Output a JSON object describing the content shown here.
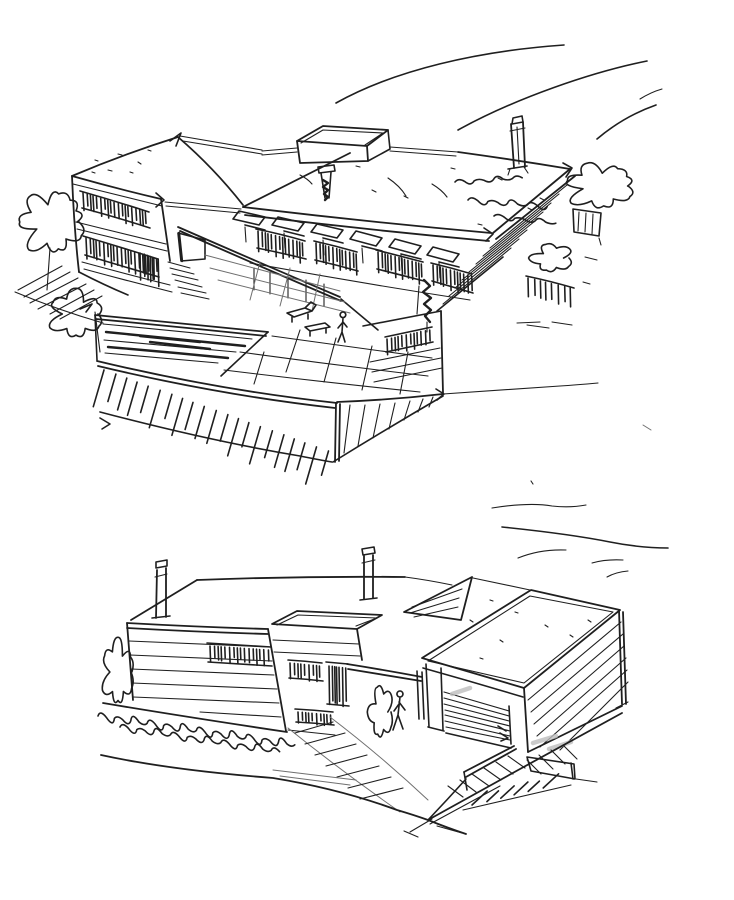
{
  "page": {
    "background": "#ffffff"
  },
  "artwork": {
    "type": "freehand ink architectural sketch",
    "ink_color": "#1f1f1f",
    "shade_color": "#bdbdbd",
    "description": "Two freehand perspective sketches of a modern flat-roofed house on a slope",
    "sketches": [
      {
        "name": "aerial-view-sketch",
        "description": "Bird's-eye perspective: two-storey volume with green roofs, roof monitor, two chimneys, shaded loggia with skylight row, paved terrace with pool, figures, trees and hatched hillside"
      },
      {
        "name": "street-view-sketch",
        "description": "Eye-level perspective: banded siding volume with chimneys, entry canopy, garage block with roller door, sloping driveway, bushes and contour lines"
      }
    ]
  }
}
